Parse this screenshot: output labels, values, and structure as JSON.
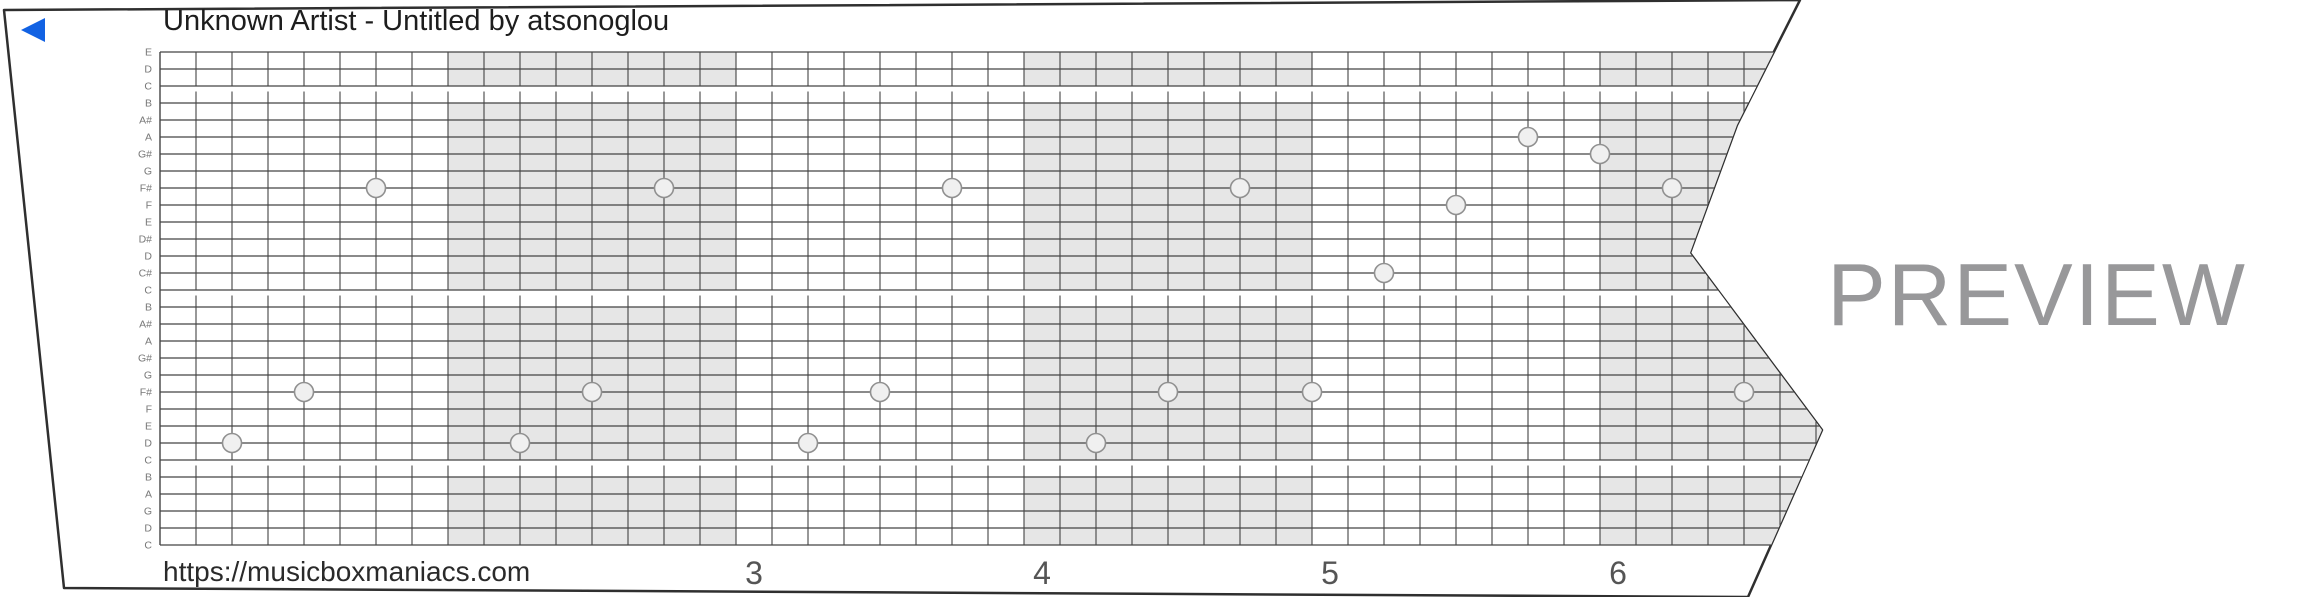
{
  "header": {
    "title": "Unknown Artist - Untitled by atsonoglou",
    "play_icon": "left-triangle",
    "play_color": "#1262e3"
  },
  "footer": {
    "url": "https://musicboxmaniacs.com",
    "measure_labels": [
      {
        "text": "3",
        "x": 754
      },
      {
        "text": "4",
        "x": 1042
      },
      {
        "text": "5",
        "x": 1330
      },
      {
        "text": "6",
        "x": 1618
      }
    ]
  },
  "watermark": {
    "text": "PREVIEW",
    "color": "#98989a"
  },
  "strip": {
    "paper_outline": "4,10 1800,0 1737,125 1690,253 1822,430 1748,597 64,588",
    "colors": {
      "paper_fill": "#ffffff",
      "paper_stroke": "#2f2f2f",
      "grid_line": "#444444",
      "measure_shade": "#e6e6e6",
      "note_fill": "#f0f0f0",
      "note_stroke": "#909090",
      "label_color": "#777777",
      "title_color": "#1d1d1d",
      "url_color": "#2a2a2a",
      "number_color": "#555555"
    },
    "grid": {
      "left": 160,
      "right": 1860,
      "top": 52,
      "row_height": 17,
      "num_lines": 30,
      "cell_width": 36,
      "measure_cells": 8,
      "shaded_measures_x": [
        448,
        1024,
        1600
      ],
      "gap_after_lines": [
        2,
        14,
        24
      ]
    },
    "note_labels": [
      "E",
      "D",
      "C",
      "B",
      "A#",
      "A",
      "G#",
      "G",
      "F#",
      "F",
      "E",
      "D#",
      "D",
      "C#",
      "C",
      "B",
      "A#",
      "A",
      "G#",
      "G",
      "F#",
      "F",
      "E",
      "D",
      "C",
      "B",
      "A",
      "G",
      "D",
      "C"
    ],
    "notes": [
      {
        "pitch": "D",
        "line": 23,
        "x": 232
      },
      {
        "pitch": "F#",
        "line": 20,
        "x": 304
      },
      {
        "pitch": "F#",
        "line": 8,
        "x": 376
      },
      {
        "pitch": "D",
        "line": 23,
        "x": 520
      },
      {
        "pitch": "F#",
        "line": 20,
        "x": 592
      },
      {
        "pitch": "F#",
        "line": 8,
        "x": 664
      },
      {
        "pitch": "D",
        "line": 23,
        "x": 808
      },
      {
        "pitch": "F#",
        "line": 20,
        "x": 880
      },
      {
        "pitch": "F#",
        "line": 8,
        "x": 952
      },
      {
        "pitch": "D",
        "line": 23,
        "x": 1096
      },
      {
        "pitch": "F#",
        "line": 20,
        "x": 1168
      },
      {
        "pitch": "F#",
        "line": 8,
        "x": 1240
      },
      {
        "pitch": "F#",
        "line": 20,
        "x": 1312
      },
      {
        "pitch": "C#",
        "line": 13,
        "x": 1384
      },
      {
        "pitch": "F",
        "line": 9,
        "x": 1456
      },
      {
        "pitch": "A",
        "line": 5,
        "x": 1528
      },
      {
        "pitch": "G#",
        "line": 6,
        "x": 1600
      },
      {
        "pitch": "F#",
        "line": 8,
        "x": 1672
      },
      {
        "pitch": "F#",
        "line": 20,
        "x": 1744
      }
    ]
  }
}
